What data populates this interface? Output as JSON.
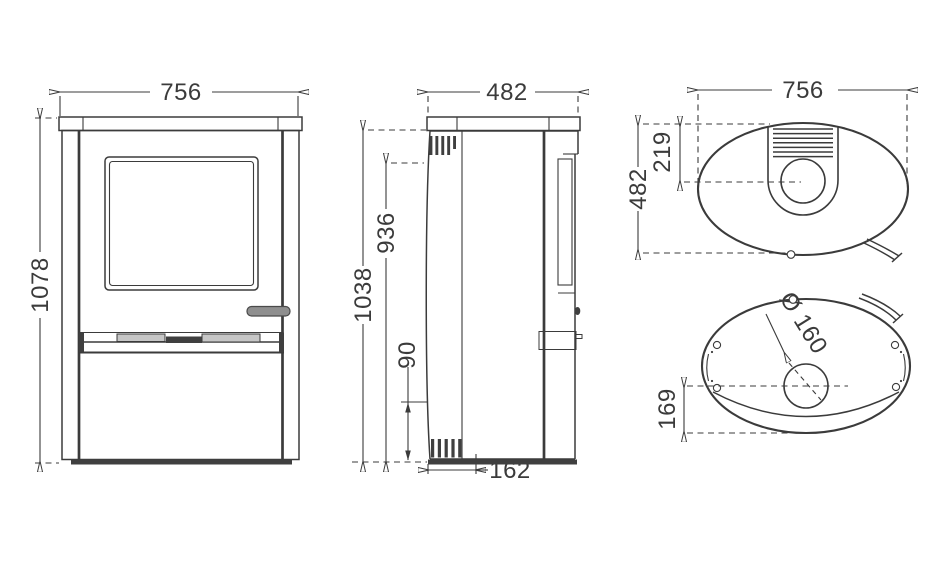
{
  "views": {
    "front": {
      "width": "756",
      "height": "1078"
    },
    "side": {
      "depth": "482",
      "height_to_top": "1038",
      "rear_outlet_height": "936",
      "lower_vent_height": "90",
      "rear_distance": "162"
    },
    "top": {
      "width": "756",
      "depth": "482",
      "flue_offset": "219"
    },
    "bottom": {
      "flue_diameter": "Ø 160",
      "flue_offset": "169"
    }
  },
  "colors": {
    "line": "#3b3b3b",
    "dark_fill": "#3f3f3f",
    "handle_fill": "#8f8f8f",
    "grille_light": "#c6c6c6",
    "background": "#ffffff"
  }
}
